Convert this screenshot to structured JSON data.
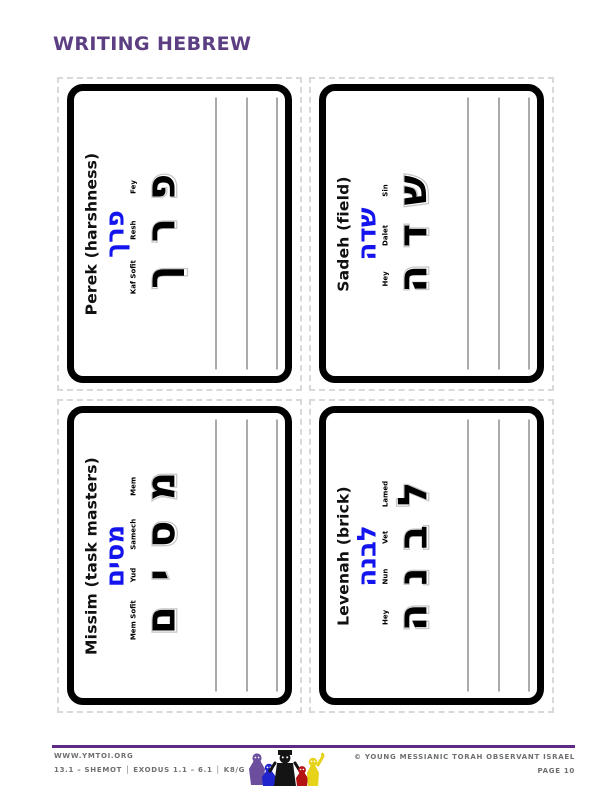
{
  "page": {
    "title": "WRITING HEBREW"
  },
  "colors": {
    "title_purple": "#5c3f82",
    "footer_rule_purple": "#5f2a85",
    "hebrew_word_blue": "#1414ef",
    "card_border": "#000000",
    "cut_line_gray": "#d9d9d9",
    "practice_line_gray": "#565656"
  },
  "cards": [
    {
      "label": "Perek (harshness)",
      "word": "פרך",
      "letters": [
        {
          "name": "Kaf Sofit",
          "glyph": "ך"
        },
        {
          "name": "Resh",
          "glyph": "ר"
        },
        {
          "name": "Fey",
          "glyph": "פ"
        }
      ]
    },
    {
      "label": "Sadeh (field)",
      "word": "שדה",
      "letters": [
        {
          "name": "Hey",
          "glyph": "ה"
        },
        {
          "name": "Dalet",
          "glyph": "ד"
        },
        {
          "name": "Sin",
          "glyph": "ש"
        }
      ]
    },
    {
      "label": "Missim (task masters)",
      "word": "מסים",
      "letters": [
        {
          "name": "Mem Sofit",
          "glyph": "ם"
        },
        {
          "name": "Yud",
          "glyph": "י"
        },
        {
          "name": "Samech",
          "glyph": "ס"
        },
        {
          "name": "Mem",
          "glyph": "מ"
        }
      ]
    },
    {
      "label": "Levenah (brick)",
      "word": "לבנה",
      "letters": [
        {
          "name": "Hey",
          "glyph": "ה"
        },
        {
          "name": "Nun",
          "glyph": "נ"
        },
        {
          "name": "Vet",
          "glyph": "ב"
        },
        {
          "name": "Lamed",
          "glyph": "ל"
        }
      ]
    }
  ],
  "footer": {
    "website": "WWW.YMTOI.ORG",
    "lesson_info": "13.1 – SHEMOT │ EXODUS 1.1 – 6.1 │ K8/G",
    "copyright": "© YOUNG MESSIANIC TORAH OBSERVANT ISRAEL",
    "page_number": "PAGE 10"
  }
}
